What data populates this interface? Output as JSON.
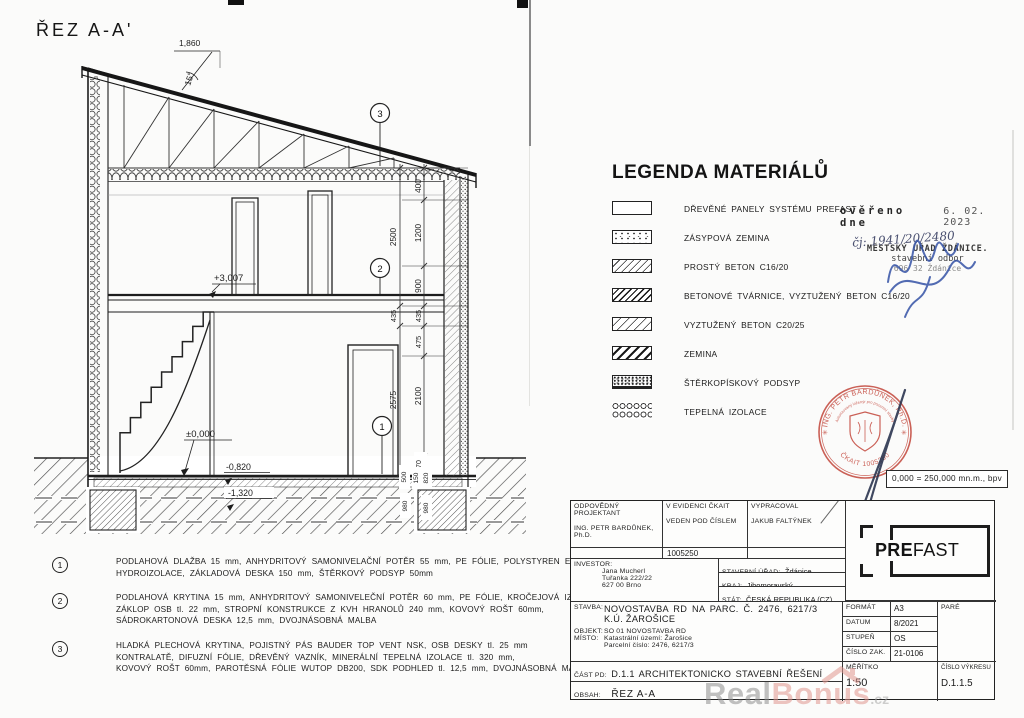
{
  "page": {
    "title": "ŘEZ A-A'"
  },
  "drawing": {
    "levels": {
      "upper": "+3,007",
      "zero": "±0,000",
      "minus082": "-0,820",
      "minus132": "-1,320"
    },
    "top_dim": "1,860",
    "angle": "15°",
    "callouts": {
      "c1": "1",
      "c2": "2",
      "c3": "3"
    },
    "dims": {
      "d400": "400",
      "d1200": "1200",
      "d2500": "2500",
      "d900": "900",
      "d435a": "435",
      "d435b": "435",
      "d475": "475",
      "d2575": "2575",
      "d2100": "2100",
      "d170": "170",
      "d500": "500",
      "d150": "150",
      "d820": "820",
      "d980a": "980",
      "d980b": "980"
    }
  },
  "legend": {
    "title": "LEGENDA MATERIÁLŮ",
    "items": [
      {
        "label": "DŘEVĚNÉ PANELY SYSTÉMU PREFAST",
        "pattern": "empty"
      },
      {
        "label": "ZÁSYPOVÁ ZEMINA",
        "pattern": "stipple"
      },
      {
        "label": "PROSTÝ BETON C16/20",
        "pattern": "hatch-thin"
      },
      {
        "label": "BETONOVÉ TVÁRNICE, VYZTUŽENÝ BETON C16/20",
        "pattern": "hatch-bold"
      },
      {
        "label": "VYZTUŽENÝ BETON C20/25",
        "pattern": "hatch-medium"
      },
      {
        "label": "ZEMINA",
        "pattern": "hatch-wide"
      },
      {
        "label": "ŠTĚRKOPÍSKOVÝ PODSYP",
        "pattern": "stipple-dense"
      },
      {
        "label": "TEPELNÁ IZOLACE",
        "pattern": "loops"
      }
    ]
  },
  "notes": [
    {
      "num": "1",
      "lines": [
        "PODLAHOVÁ DLAŽBA 15 mm, ANHYDRITOVÝ SAMONIVELAČNÍ POTĚR 55 mm, PE FÓLIE, POLYSTYREN EPS 150 S GREY tl. 100mm,",
        "HYDROIZOLACE, ZÁKLADOVÁ DESKA 150 mm, ŠTĚRKOVÝ PODSYP 50mm"
      ]
    },
    {
      "num": "2",
      "lines": [
        "PODLAHOVÁ KRYTINA 15 mm, ANHYDRITOVÝ SAMONIVELEČNÍ POTĚR 60 mm, PE FÓLIE, KROČEJOVÁ IZOLACE 20 mm,",
        "ZÁKLOP OSB tl. 22 mm, STROPNÍ KONSTRUKCE Z KVH HRANOLŮ 240 mm, KOVOVÝ ROŠT 60mm,",
        "SÁDROKARTONOVÁ DESKA 12,5 mm, DVOJNÁSOBNÁ MALBA"
      ]
    },
    {
      "num": "3",
      "lines": [
        "HLADKÁ PLECHOVÁ KRYTINA, POJISTNÝ PÁS BAUDER TOP VENT NSK, OSB DESKY tl. 25 mm",
        "KONTRALATĚ, DIFUZNÍ FÓLIE, DŘEVĚNÝ VAZNÍK, MINERÁLNÍ TEPELNÁ IZOLACE tl. 320 mm,",
        "KOVOVÝ ROŠT 60mm, PAROTĚSNÁ FÓLIE WUTOP DB200, SDK PODHLED tl. 12,5 mm, DVOJNÁSOBNÁ MALBA"
      ]
    }
  ],
  "stamps": {
    "verified": {
      "word": "ověřeno dne",
      "date": "6. 02. 2023",
      "handwritten": "čj: 1941/20/2480",
      "office1": "MĚSTSKÝ ÚŘAD ŽDÁNICE.",
      "office2": "stavební odbor",
      "office3": "696 32 Ždánice"
    },
    "round": {
      "top": "ING. PETR BARDŮNEK, Ph.D.",
      "middle": "Autorizovaný inženýr pro pozemní stavby",
      "bottom": "ČKAIT 1005250"
    },
    "elevation_note": "0,000 = 250,000 mn.m., bpv"
  },
  "titleblock": {
    "responsible_label": "ODPOVĚDNÝ PROJEKTANT",
    "responsible_name": "ING. PETR BARDŮNEK, Ph.D.",
    "evidence_label1": "V EVIDENCI ČKAIT",
    "evidence_label2": "VEDEN POD ČÍSLEM",
    "evidence_number": "1005250",
    "prepared_label": "VYPRACOVAL",
    "prepared_name": "JAKUB FALTÝNEK",
    "investor_label": "INVESTOR:",
    "investor_line1": "Jana Mucherl",
    "investor_line2": "Tuřanka 222/22",
    "investor_line3": "627 00 Brno",
    "office_label": "STAVEBNÍ ÚŘAD:",
    "office_value": "Ždánice",
    "region_label": "KRAJ:",
    "region_value": "Jihomoravský",
    "state_label": "STÁT:",
    "state_value": "ČESKÁ REPUBLIKA (CZ)",
    "stavba_label": "STAVBA:",
    "stavba_line1": "NOVOSTAVBA RD NA PARC. Č. 2476, 6217/3",
    "stavba_line2": "K.Ú. ŽAROŠICE",
    "objekt_label": "OBJEKT:",
    "objekt_value": "SO 01 NOVOSTAVBA RD",
    "misto_label": "MÍSTO:",
    "misto_line1": "Katastrální území: Žarošice",
    "misto_line2": "Parcelní číslo: 2476, 6217/3",
    "format_label": "FORMÁT",
    "format_value": "A3",
    "datum_label": "DATUM",
    "datum_value": "8/2021",
    "stupen_label": "STUPEŇ",
    "stupen_value": "OS",
    "cislo_zak_label": "ČÍSLO ZAK.",
    "cislo_zak_value": "21-0106",
    "pare_label": "PARÉ",
    "cast_pd_label": "ČÁST PD:",
    "cast_pd_value": "D.1.1 ARCHITEKTONICKO STAVEBNÍ ŘEŠENÍ",
    "obsah_label": "OBSAH:",
    "obsah_value": "ŘEZ A-A",
    "meritko_label": "MĚŘÍTKO",
    "meritko_value": "1:50",
    "cislo_vykresu_label": "ČÍSLO VÝKRESU",
    "cislo_vykresu_value": "D.1.1.5",
    "logo_bold": "PRE",
    "logo_light": "FAST"
  },
  "watermark": {
    "part1": "Real",
    "part2": "Bonus",
    "part3": ".cz"
  }
}
